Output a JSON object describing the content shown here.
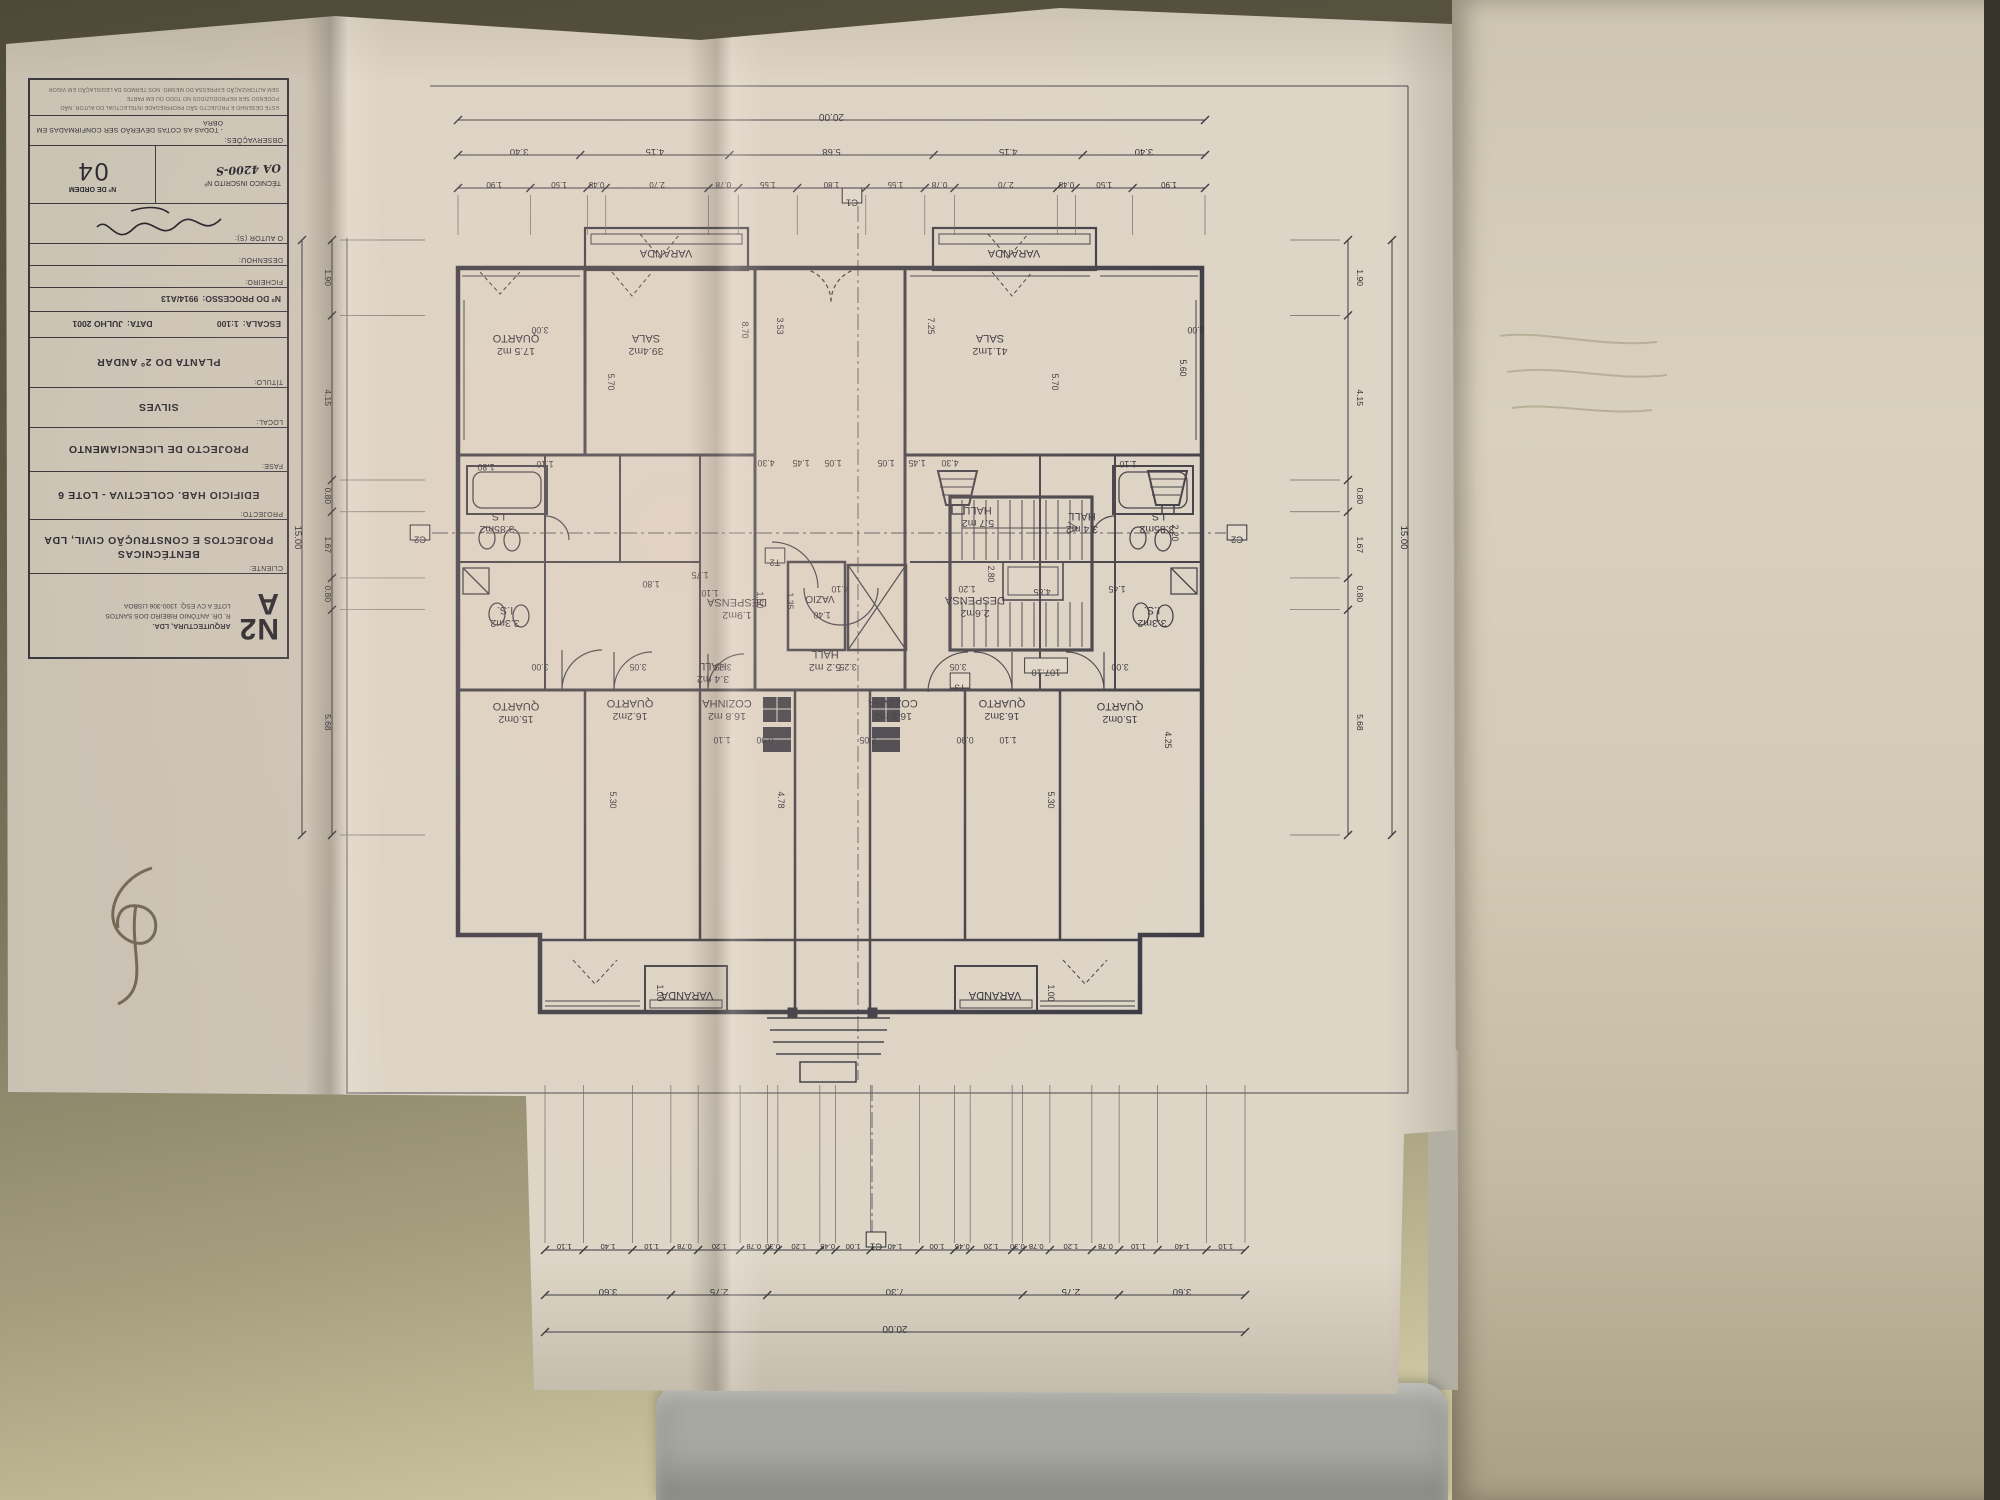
{
  "title_block": {
    "logo": {
      "mark_line1": "N2",
      "mark_line2": "A",
      "firm": "ARQUITECTURA, LDA.",
      "address1": "R. DR. ANTÓNIO RIBEIRO DOS SANTOS",
      "address2": "LOTE A CV ESQ. 1300-306 LISBOA"
    },
    "cliente": {
      "label": "CLIENTE:",
      "value1": "BENTÉCNICAS",
      "value2": "PROJECTOS E CONSTRUÇÃO CIVIL, LDA"
    },
    "projecto": {
      "label": "PROJECTO:",
      "value": "EDIFICIO  HAB.  COLECTIVA  -  LOTE  6"
    },
    "fase": {
      "label": "FASE:",
      "value": "PROJECTO DE LICENCIAMENTO"
    },
    "local": {
      "label": "LOCAL:",
      "value": "SILVES"
    },
    "titulo": {
      "label": "TÍTULO:",
      "value": "PLANTA DO 2º ANDAR"
    },
    "escala": {
      "label": "ESCALA:",
      "value": "1:100"
    },
    "data": {
      "label": "DATA:",
      "value": "JULHO 2001"
    },
    "processo": {
      "label": "Nº DO PROCESSO:",
      "value": "9914/A13"
    },
    "ficheiro": {
      "label": "FICHEIRO:"
    },
    "desenhou": {
      "label": "DESENHOU:"
    },
    "autor": {
      "label": "O AUTOR (S):"
    },
    "tecnico": {
      "label": "TÉCNICO INSCRITO Nº",
      "value": "OA 4200-S"
    },
    "ordem": {
      "label": "Nº DE ORDEM",
      "value": "04"
    },
    "observacoes": {
      "label": "OBSERVAÇÕES:",
      "value": "- TODAS AS COTAS DEVERÃO SER CONFIRMADAS EM OBRA"
    },
    "fine_print_1": "ESTE DESENHO E PROJECTO SÃO PROPRIEDADE INTELECTUAL DO AUTOR, NÃO PODENDO SER REPRODUZIDOS NO TODO OU EM PARTE",
    "fine_print_2": "SEM AUTORIZAÇÃO EXPRESSA DO MESMO, NOS TERMOS DA LEGISLAÇÃO EM VIGOR"
  },
  "plan": {
    "rooms": [
      {
        "n": "QUARTO",
        "a": "17.5 m2",
        "x": 516,
        "y": 340
      },
      {
        "n": "SALA",
        "a": "39.4m2",
        "x": 646,
        "y": 340
      },
      {
        "n": "SALA",
        "a": "41.1m2",
        "x": 990,
        "y": 340
      },
      {
        "n": "VARANDA",
        "a": "",
        "x": 666,
        "y": 250
      },
      {
        "n": "VARANDA",
        "a": "",
        "x": 1014,
        "y": 250
      },
      {
        "n": "I.S.",
        "a": "3.85m2",
        "x": 497,
        "y": 518
      },
      {
        "n": "HALL",
        "a": "5.7 m2",
        "x": 978,
        "y": 512
      },
      {
        "n": "HALL",
        "a": "3.4 m2",
        "x": 1082,
        "y": 518
      },
      {
        "n": "I.S.",
        "a": "3.85m2",
        "x": 1157,
        "y": 518
      },
      {
        "n": "I.S.",
        "a": "3.3m2",
        "x": 505,
        "y": 612
      },
      {
        "n": "DESPENSA",
        "a": "1.9m2",
        "x": 737,
        "y": 604
      },
      {
        "n": "DESPENSA",
        "a": "2.6m2",
        "x": 975,
        "y": 602
      },
      {
        "n": "I.S.",
        "a": "3.3m2",
        "x": 1152,
        "y": 612
      },
      {
        "n": "HALL",
        "a": "3.4 m2",
        "x": 713,
        "y": 668
      },
      {
        "n": "HALL",
        "a": "5.2 m2",
        "x": 825,
        "y": 656
      },
      {
        "n": "QUARTO",
        "a": "15.0m2",
        "x": 516,
        "y": 708
      },
      {
        "n": "QUARTO",
        "a": "16.2m2",
        "x": 630,
        "y": 705
      },
      {
        "n": "COZINHA",
        "a": "16.8 m2",
        "x": 727,
        "y": 705
      },
      {
        "n": "COZINHA",
        "a": "16.8 m2",
        "x": 893,
        "y": 705
      },
      {
        "n": "QUARTO",
        "a": "16.3m2",
        "x": 1002,
        "y": 705
      },
      {
        "n": "QUARTO",
        "a": "15.0m2",
        "x": 1120,
        "y": 708
      },
      {
        "n": "VARANDA",
        "a": "",
        "x": 687,
        "y": 992
      },
      {
        "n": "VARANDA",
        "a": "",
        "x": 995,
        "y": 992
      }
    ],
    "marks": [
      {
        "t": "C1",
        "x": 852,
        "y": 196,
        "box": 1
      },
      {
        "t": "C1",
        "x": 876,
        "y": 1240,
        "box": 1
      },
      {
        "t": "C2",
        "x": 420,
        "y": 533,
        "box": 1
      },
      {
        "t": "C2",
        "x": 1237,
        "y": 533,
        "box": 1
      },
      {
        "t": "T3",
        "x": 960,
        "y": 681,
        "box": 1
      },
      {
        "t": "T2",
        "x": 775,
        "y": 556,
        "box": 1
      },
      {
        "t": "107.10",
        "x": 1046,
        "y": 666,
        "box": 1
      },
      {
        "t": "VAZIO",
        "x": 820,
        "y": 596
      }
    ],
    "dims": [
      {
        "t": "3.00",
        "x": 540,
        "y": 327
      },
      {
        "t": "8.70",
        "x": 742,
        "y": 330,
        "v": 1
      },
      {
        "t": "3.53",
        "x": 777,
        "y": 326,
        "v": 1
      },
      {
        "t": "7.25",
        "x": 928,
        "y": 326,
        "v": 1
      },
      {
        "t": "5.60",
        "x": 1180,
        "y": 368,
        "v": 1
      },
      {
        "t": "5.70",
        "x": 608,
        "y": 382,
        "v": 1
      },
      {
        "t": "5.70",
        "x": 1052,
        "y": 382,
        "v": 1
      },
      {
        "t": "3.00",
        "x": 1196,
        "y": 327
      },
      {
        "t": "1.80",
        "x": 486,
        "y": 464
      },
      {
        "t": "1.10",
        "x": 545,
        "y": 461
      },
      {
        "t": "4.30",
        "x": 766,
        "y": 460
      },
      {
        "t": "1.45",
        "x": 801,
        "y": 460
      },
      {
        "t": "1.05",
        "x": 833,
        "y": 460
      },
      {
        "t": "1.05",
        "x": 886,
        "y": 460
      },
      {
        "t": "1.45",
        "x": 917,
        "y": 460
      },
      {
        "t": "4.30",
        "x": 950,
        "y": 460
      },
      {
        "t": "1.10",
        "x": 1128,
        "y": 461
      },
      {
        "t": "1.80",
        "x": 651,
        "y": 581
      },
      {
        "t": "1.75",
        "x": 700,
        "y": 572
      },
      {
        "t": "1.10",
        "x": 710,
        "y": 590
      },
      {
        "t": "4.10",
        "x": 840,
        "y": 586
      },
      {
        "t": "1.20",
        "x": 967,
        "y": 586
      },
      {
        "t": "2.80",
        "x": 988,
        "y": 574,
        "v": 1
      },
      {
        "t": "4.85",
        "x": 1042,
        "y": 589
      },
      {
        "t": "1.45",
        "x": 1117,
        "y": 586
      },
      {
        "t": "1.60",
        "x": 757,
        "y": 600,
        "v": 1
      },
      {
        "t": "1.35",
        "x": 787,
        "y": 601,
        "v": 1
      },
      {
        "t": "1.40",
        "x": 822,
        "y": 612
      },
      {
        "t": "2.20",
        "x": 1172,
        "y": 533,
        "v": 1
      },
      {
        "t": "1.10",
        "x": 722,
        "y": 737
      },
      {
        "t": "0.90",
        "x": 765,
        "y": 737
      },
      {
        "t": "2.05",
        "x": 868,
        "y": 737
      },
      {
        "t": "0.90",
        "x": 965,
        "y": 737
      },
      {
        "t": "1.10",
        "x": 1008,
        "y": 737
      },
      {
        "t": "3.00",
        "x": 540,
        "y": 664
      },
      {
        "t": "3.05",
        "x": 638,
        "y": 664
      },
      {
        "t": "3.25",
        "x": 723,
        "y": 664
      },
      {
        "t": "3.25",
        "x": 848,
        "y": 664
      },
      {
        "t": "3.05",
        "x": 958,
        "y": 664
      },
      {
        "t": "3.00",
        "x": 1120,
        "y": 664
      },
      {
        "t": "5.30",
        "x": 610,
        "y": 800,
        "v": 1
      },
      {
        "t": "4.78",
        "x": 778,
        "y": 800,
        "v": 1
      },
      {
        "t": "5.30",
        "x": 1048,
        "y": 800,
        "v": 1
      },
      {
        "t": "4.25",
        "x": 1165,
        "y": 740,
        "v": 1
      },
      {
        "t": "1.00",
        "x": 657,
        "y": 993,
        "v": 1
      },
      {
        "t": "1.00",
        "x": 1048,
        "y": 993,
        "v": 1
      }
    ],
    "chains": {
      "top": {
        "overall": "20.00",
        "row2": [
          "3.40",
          "4.15",
          "5.68",
          "4.15",
          "3.40"
        ],
        "row3": [
          "1.90",
          "1.50",
          "0.48",
          "2.70",
          "0.78",
          "1.55",
          "1.80",
          "1.55",
          "0.78",
          "2.70",
          "0.48",
          "1.50",
          "1.90"
        ]
      },
      "bottom": {
        "overall": "20.00",
        "row2": [
          "3.60",
          "2.75",
          "7.30",
          "2.75",
          "3.60"
        ],
        "row1": [
          "1.10",
          "1.40",
          "1.10",
          "0.78",
          "1.20",
          "0.78",
          "0.30",
          "1.20",
          "0.45",
          "1.00",
          "1.40",
          "1.00",
          "0.45",
          "1.20",
          "0.30",
          "0.78",
          "1.20",
          "0.78",
          "1.10",
          "1.40",
          "1.10"
        ]
      },
      "left": {
        "overall": "15.00",
        "vals": [
          "1.90",
          "4.15",
          "0.80",
          "1.67",
          "0.80",
          "5.68"
        ]
      },
      "right": {
        "overall": "15.00",
        "vals": [
          "1.90",
          "4.15",
          "0.80",
          "1.67",
          "0.80",
          "5.68"
        ]
      }
    }
  }
}
